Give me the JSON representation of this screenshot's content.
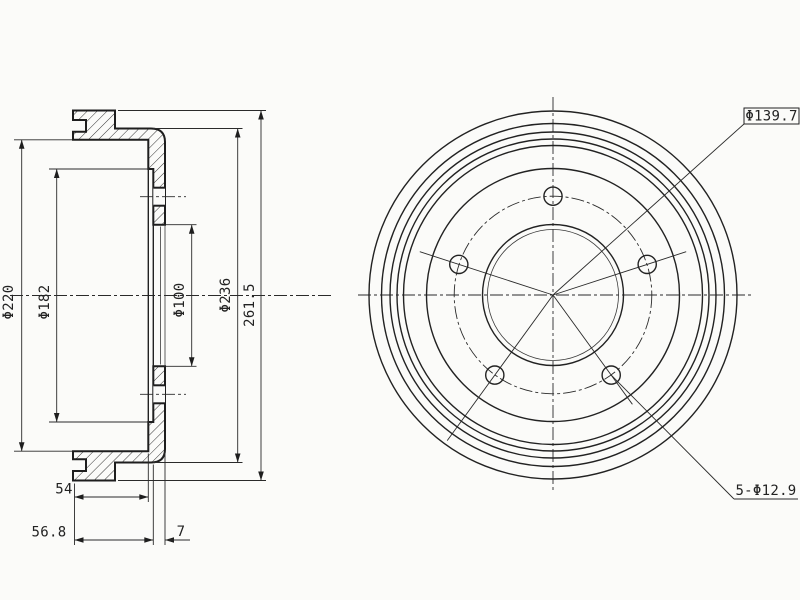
{
  "colors": {
    "background": "#fbfbf9",
    "line": "#222222"
  },
  "section_view": {
    "dims": {
      "phi220": "Φ220",
      "phi182": "Φ182",
      "phi100": "Φ100",
      "phi236": "Φ236",
      "overall": "261.5",
      "depth_54": "54",
      "depth_56_8": "56.8",
      "web_7": "7"
    }
  },
  "front_view": {
    "bolt_circle": "Φ139.7",
    "bolt_holes": "5-Φ12.9"
  }
}
